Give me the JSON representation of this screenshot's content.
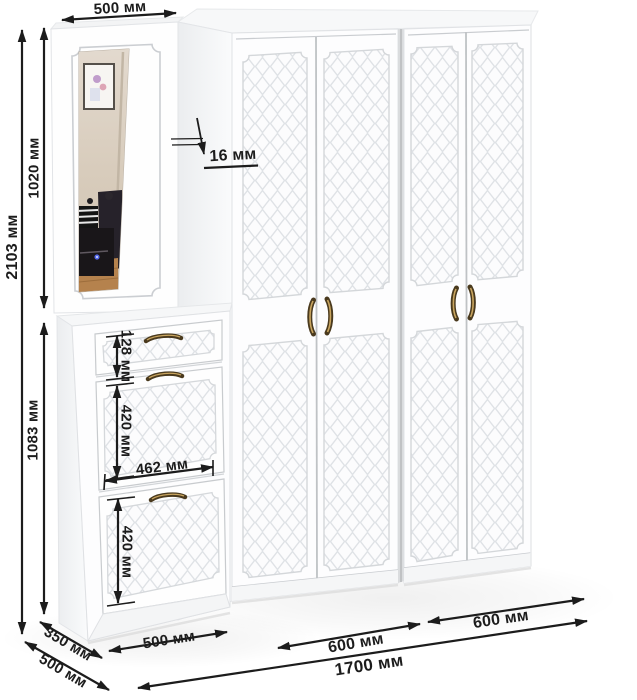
{
  "dimensions": {
    "top_width": "500 мм",
    "total_height": "2103 мм",
    "mirror_section_height": "1020 мм",
    "cabinet_section_height": "1083 мм",
    "drawer_height": "128 мм",
    "upper_door_height": "420 мм",
    "door_width": "462 мм",
    "lower_door_height": "420 мм",
    "panel_thickness": "16 мм",
    "cabinet_depth": "350 мм",
    "wardrobe_depth": "500 мм",
    "cabinet_width": "500 мм",
    "left_wardrobe_width": "600 мм",
    "right_wardrobe_width": "600 мм",
    "total_width": "1700 мм"
  },
  "colors": {
    "dimension_ink": "#1c1c1c",
    "furniture_white": "#ffffff",
    "panel_groove": "#dcdfe3",
    "handle_bronze": "#6b5526",
    "mirror_wall_beige": "#d8cec3",
    "mirror_floor_wood": "#b5824d"
  }
}
